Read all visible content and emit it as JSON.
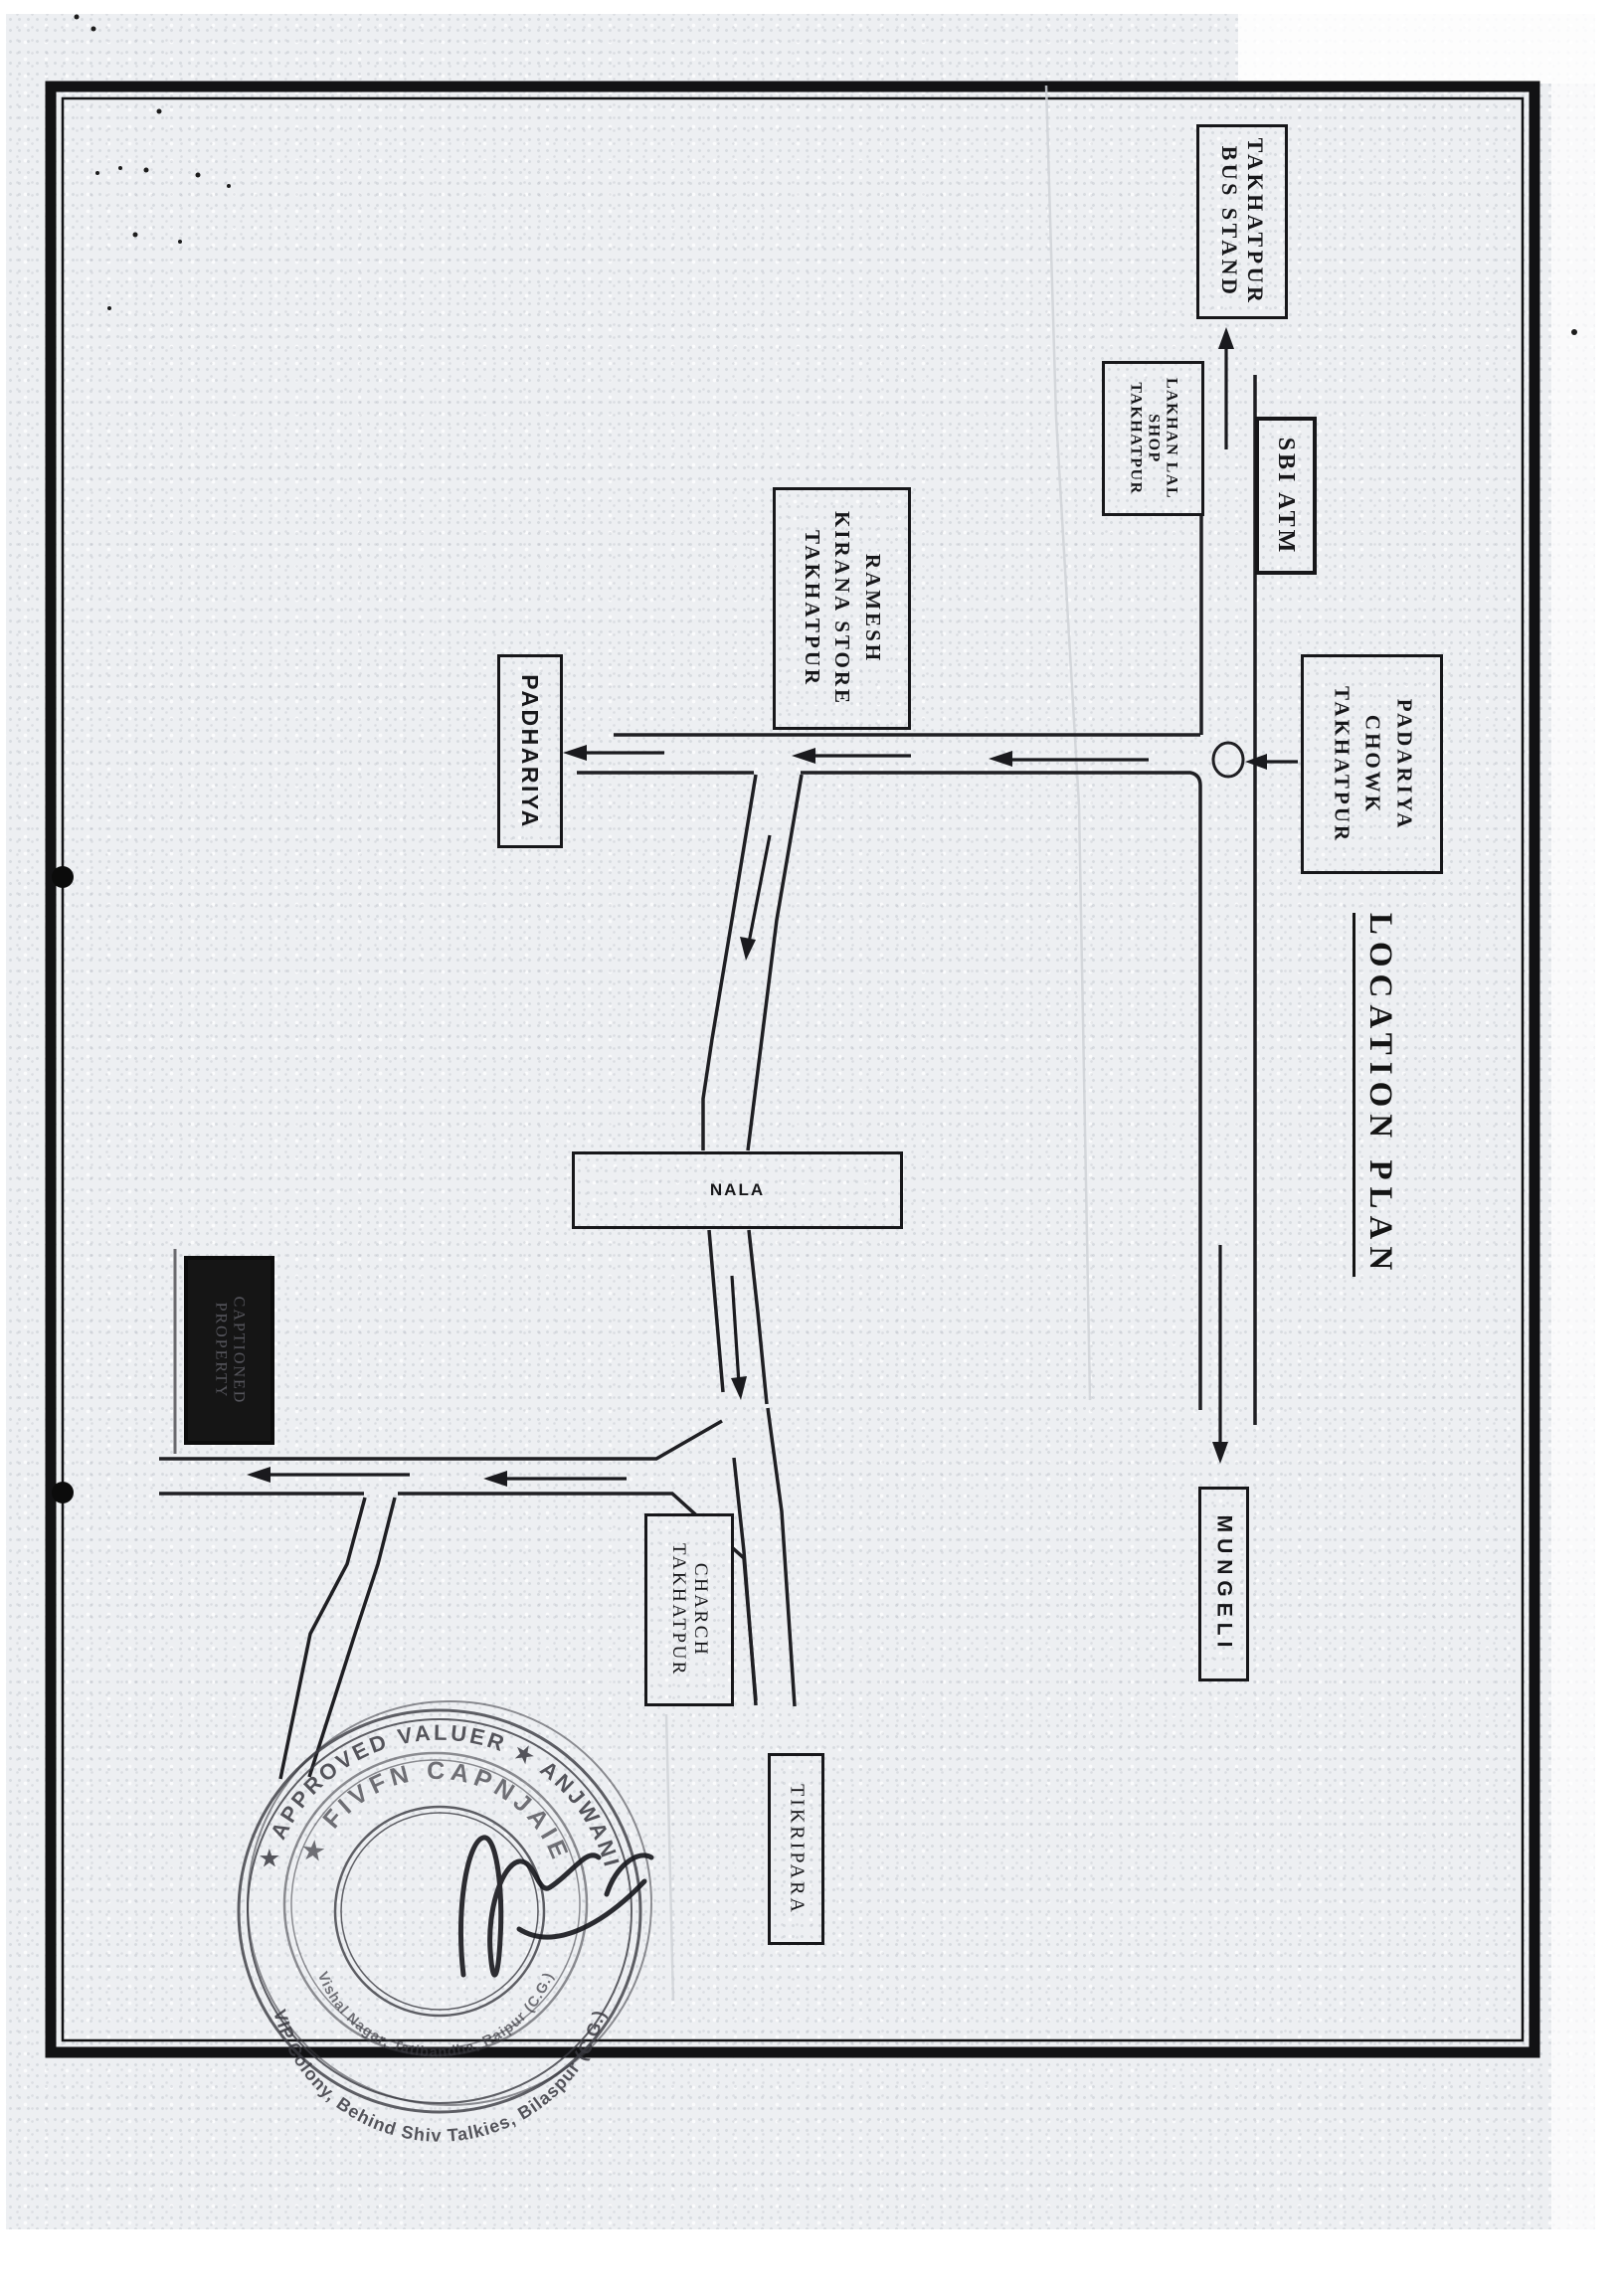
{
  "title": "LOCATION PLAN",
  "places": {
    "bus_stand": {
      "lines": [
        "TAKHATPUR",
        "BUS STAND"
      ]
    },
    "lakhan_shop": {
      "lines": [
        "LAKHAN LAL",
        "SHOP",
        "TAKHATPUR"
      ]
    },
    "sbi_atm": {
      "lines": [
        "SBI ATM"
      ]
    },
    "ramesh_store": {
      "lines": [
        "RAMESH",
        "KIRANA STORE",
        "TAKHATPUR"
      ]
    },
    "padhariya": {
      "lines": [
        "PADHARIYA"
      ]
    },
    "padariya_chowk": {
      "lines": [
        "PADARIYA",
        "CHOWK",
        "TAKHATPUR"
      ]
    },
    "nala": {
      "lines": [
        "NALA"
      ]
    },
    "captioned_property": {
      "lines": [
        "CAPTIONED",
        "PROPERTY"
      ]
    },
    "charch": {
      "lines": [
        "CHARCH",
        "TAKHATPUR"
      ]
    },
    "tikripara": {
      "lines": [
        "TIKRIPARA"
      ]
    },
    "mungeli": {
      "lines": [
        "MUNGELI"
      ]
    }
  },
  "stamp": {
    "ring_top": "★ APPROVED VALUER ★ ANJWANI",
    "ring_bottom_outer": "VIP Colony, Behind Shiv Talkies, Bilaspur (C.G.)",
    "ring_name": "★ FIVFN CAPNJAIE",
    "ring_bottom_inner": "Vishal Nagar, Tatibandha, Raipur (C.G.)"
  },
  "colors": {
    "ink": "#1f1f23",
    "stamp_ink": "#3a3a41",
    "paper": "#edeff2",
    "captioned_box_bg": "#151515"
  }
}
